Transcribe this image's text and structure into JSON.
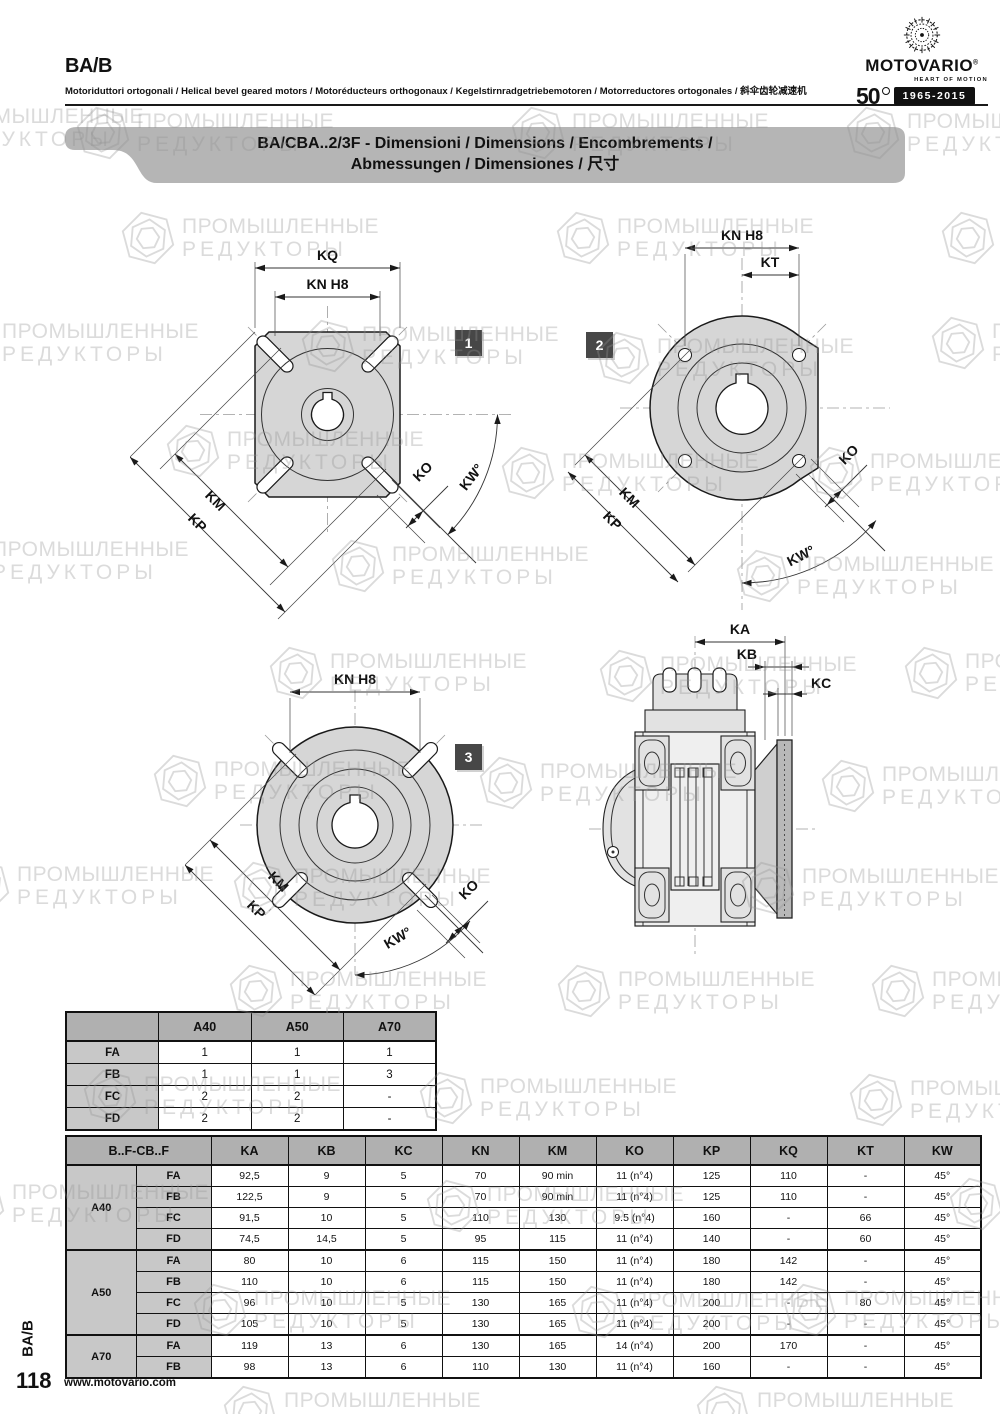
{
  "header": {
    "title": "BA/B",
    "subtitle": "Motoriduttori ortogonali / Helical bevel geared motors / Motoréducteurs orthogonaux / Kegelstirnradgetriebemotoren / Motorreductores ortogonales / 斜伞齿轮减速机"
  },
  "logo": {
    "brand": "MOTOVARIO",
    "registered": "®",
    "tagline": "HEART OF MOTION",
    "anniversary_number": "50",
    "anniversary_years": "1965-2015"
  },
  "banner": {
    "line1": "BA/CBA..2/3F - Dimensioni / Dimensions / Encombrements /",
    "line2": "Abmessungen / Dimensiones / 尺寸"
  },
  "watermark": {
    "line1": "ПРОМЫШЛЕННЫЕ",
    "line2": "РЕДУКТОРЫ"
  },
  "drawings": {
    "d1": {
      "badge": "1",
      "labels": {
        "kq": "KQ",
        "kn": "KN H8",
        "km": "KM",
        "kp": "KP",
        "ko": "KO",
        "kw": "KW°"
      }
    },
    "d2": {
      "badge": "2",
      "labels": {
        "kn": "KN H8",
        "kt": "KT",
        "km": "KM",
        "kp": "KP",
        "ko": "KO",
        "kw": "KW°"
      }
    },
    "d3": {
      "badge": "3",
      "labels": {
        "kn": "KN H8",
        "km": "KM",
        "kp": "KP",
        "ko": "KO",
        "kw": "KW°"
      }
    },
    "d4": {
      "labels": {
        "ka": "KA",
        "kb": "KB",
        "kc": "KC"
      }
    }
  },
  "flange_table": {
    "headers": [
      "",
      "A40",
      "A50",
      "A70"
    ],
    "rows": [
      {
        "label": "FA",
        "values": [
          "1",
          "1",
          "1"
        ]
      },
      {
        "label": "FB",
        "values": [
          "1",
          "1",
          "3"
        ]
      },
      {
        "label": "FC",
        "values": [
          "2",
          "2",
          "-"
        ]
      },
      {
        "label": "FD",
        "values": [
          "2",
          "2",
          "-"
        ]
      }
    ]
  },
  "dim_table": {
    "group_header": "B..F-CB..F",
    "col_headers": [
      "KA",
      "KB",
      "KC",
      "KN",
      "KM",
      "KO",
      "KP",
      "KQ",
      "KT",
      "KW"
    ],
    "groups": [
      {
        "name": "A40",
        "rows": [
          {
            "label": "FA",
            "values": [
              "92,5",
              "9",
              "5",
              "70",
              "90 min",
              "11 (n°4)",
              "125",
              "110",
              "-",
              "45°"
            ]
          },
          {
            "label": "FB",
            "values": [
              "122,5",
              "9",
              "5",
              "70",
              "90 min",
              "11 (n°4)",
              "125",
              "110",
              "-",
              "45°"
            ]
          },
          {
            "label": "FC",
            "values": [
              "91,5",
              "10",
              "5",
              "110",
              "130",
              "9.5 (n°4)",
              "160",
              "-",
              "66",
              "45°"
            ]
          },
          {
            "label": "FD",
            "values": [
              "74,5",
              "14,5",
              "5",
              "95",
              "115",
              "11 (n°4)",
              "140",
              "-",
              "60",
              "45°"
            ]
          }
        ]
      },
      {
        "name": "A50",
        "rows": [
          {
            "label": "FA",
            "values": [
              "80",
              "10",
              "6",
              "115",
              "150",
              "11 (n°4)",
              "180",
              "142",
              "-",
              "45°"
            ]
          },
          {
            "label": "FB",
            "values": [
              "110",
              "10",
              "6",
              "115",
              "150",
              "11 (n°4)",
              "180",
              "142",
              "-",
              "45°"
            ]
          },
          {
            "label": "FC",
            "values": [
              "96",
              "10",
              "5",
              "130",
              "165",
              "11 (n°4)",
              "200",
              "-",
              "80",
              "45°"
            ]
          },
          {
            "label": "FD",
            "values": [
              "105",
              "10",
              "5",
              "130",
              "165",
              "11 (n°4)",
              "200",
              "-",
              "-",
              "45°"
            ]
          }
        ]
      },
      {
        "name": "A70",
        "rows": [
          {
            "label": "FA",
            "values": [
              "119",
              "13",
              "6",
              "130",
              "165",
              "14 (n°4)",
              "200",
              "170",
              "-",
              "45°"
            ]
          },
          {
            "label": "FB",
            "values": [
              "98",
              "13",
              "6",
              "110",
              "130",
              "11 (n°4)",
              "160",
              "-",
              "-",
              "45°"
            ]
          }
        ]
      }
    ]
  },
  "footer": {
    "side_label": "BA/B",
    "page_number": "118",
    "website": "www.motovario.com"
  }
}
